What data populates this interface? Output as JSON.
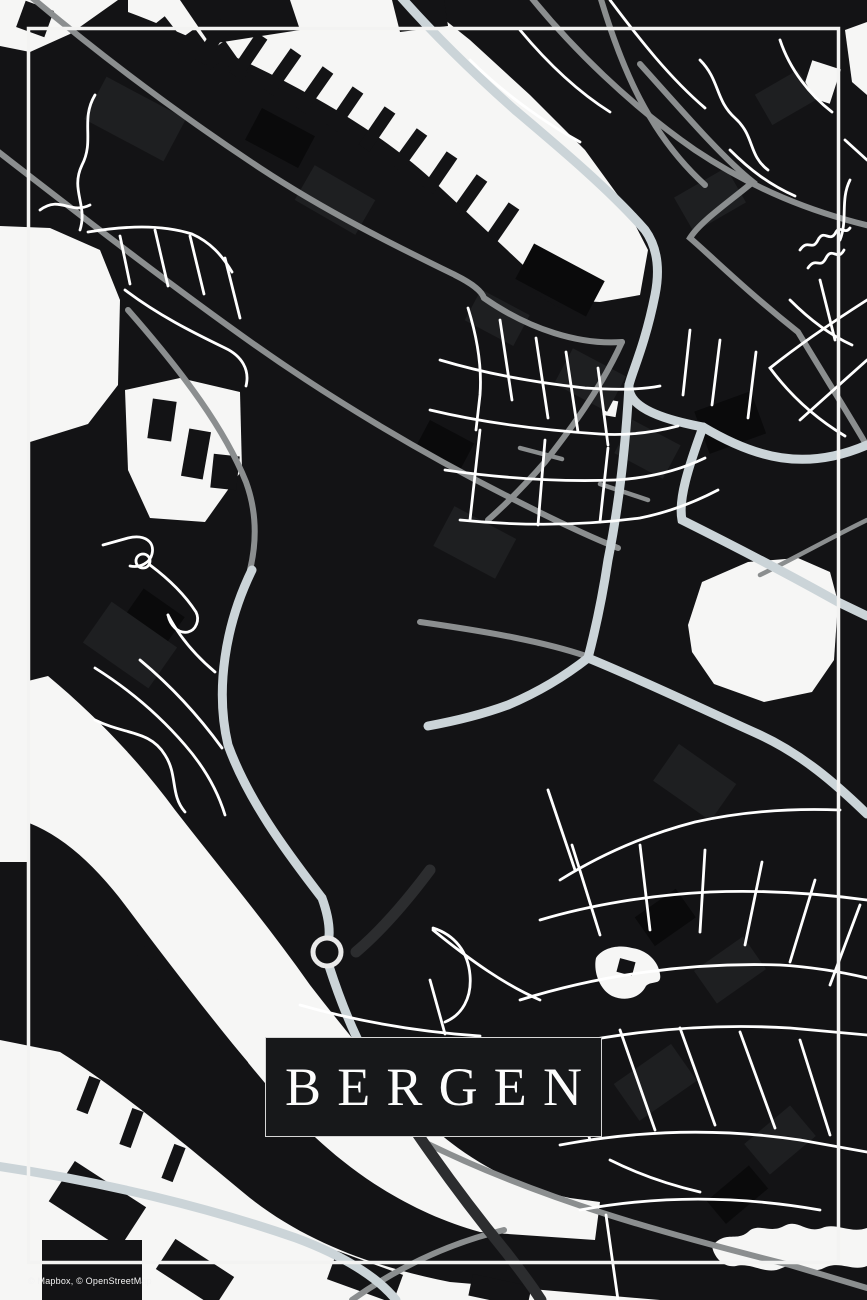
{
  "poster": {
    "title": "BERGEN",
    "attribution": "© Mapbox, © OpenStreetMap"
  },
  "map": {
    "style": "black-and-white street map poster",
    "features": [
      "harbor-water-band",
      "left-fjord-water",
      "bottom-water-band",
      "octagon-lake",
      "small-pond",
      "roundabout",
      "bridge",
      "inset-frame"
    ]
  },
  "colors": {
    "background": "#131315",
    "water": "#f6f6f5",
    "road_minor": "#ffffff",
    "road_secondary": "#8b8e8f",
    "road_primary": "#cbd4d8",
    "road_bridge": "#2c2d2f",
    "frame": "#f3f3f2",
    "title_box_bg": "#17181a",
    "title_box_border": "#d6d6d6",
    "title_text": "#fdfdfd",
    "attribution_text": "#f2f2f2",
    "building_light": "#1e1f21",
    "building_dark": "#0a0a0b"
  }
}
